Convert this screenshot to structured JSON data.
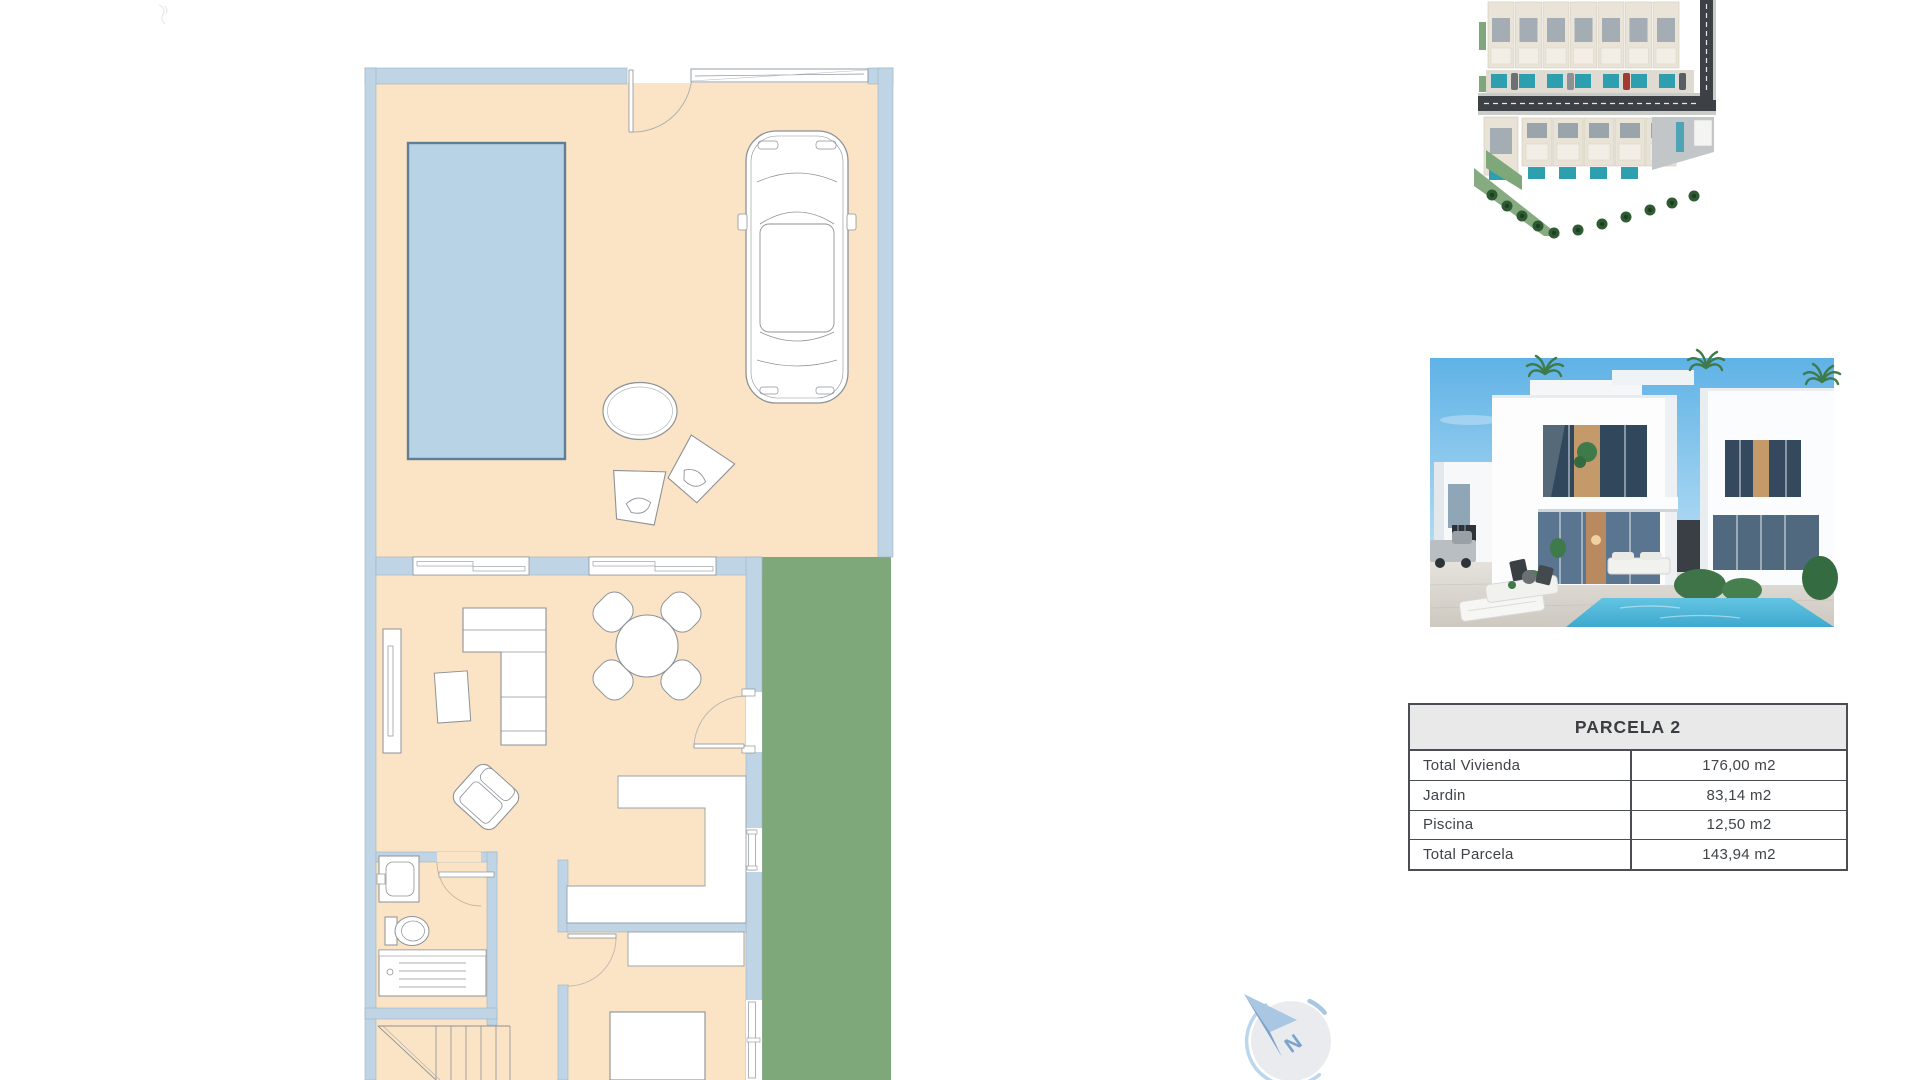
{
  "parcela_table": {
    "title": "PARCELA 2",
    "rows": [
      {
        "label": "Total Vivienda",
        "value": "176,00 m2"
      },
      {
        "label": "Jardin",
        "value": "83,14 m2"
      },
      {
        "label": "Piscina",
        "value": "12,50 m2"
      },
      {
        "label": "Total Parcela",
        "value": "143,94 m2"
      }
    ]
  },
  "compass": {
    "letter": "N"
  },
  "floor_plan": {
    "colors": {
      "floor": "#fbe4c5",
      "wall": "#bfd4e4",
      "garden": "#7fa87a",
      "pool_fill": "#b9d3e6",
      "pool_border": "#5f7f99",
      "outline": "#8d9298"
    },
    "elements": [
      "pool",
      "car",
      "terrace-table",
      "lounge-chair",
      "entry-door",
      "garage-door",
      "sofa",
      "armchair",
      "coffee-table",
      "tv-unit",
      "dining-table",
      "dining-chair",
      "garden-door",
      "kitchen-counter",
      "sink",
      "toilet",
      "shower",
      "stairs",
      "bed"
    ]
  },
  "site_plan": {
    "colors": {
      "road": "#3d4145",
      "plot": "#eae4d8",
      "roof": "#a3adb3",
      "pool": "#2e9fae",
      "green": "#7fa87a",
      "palm": "#2f5b33"
    }
  },
  "render": {
    "colors": {
      "sky_top": "#5fb2e6",
      "sky_bottom": "#d6edf9",
      "building": "#fdfdfd",
      "glass": "#31485c",
      "wood": "#c59a6b",
      "pool": "#49b6d8",
      "plants": "#3f7a4a",
      "paving": "#d9d5cf"
    }
  }
}
